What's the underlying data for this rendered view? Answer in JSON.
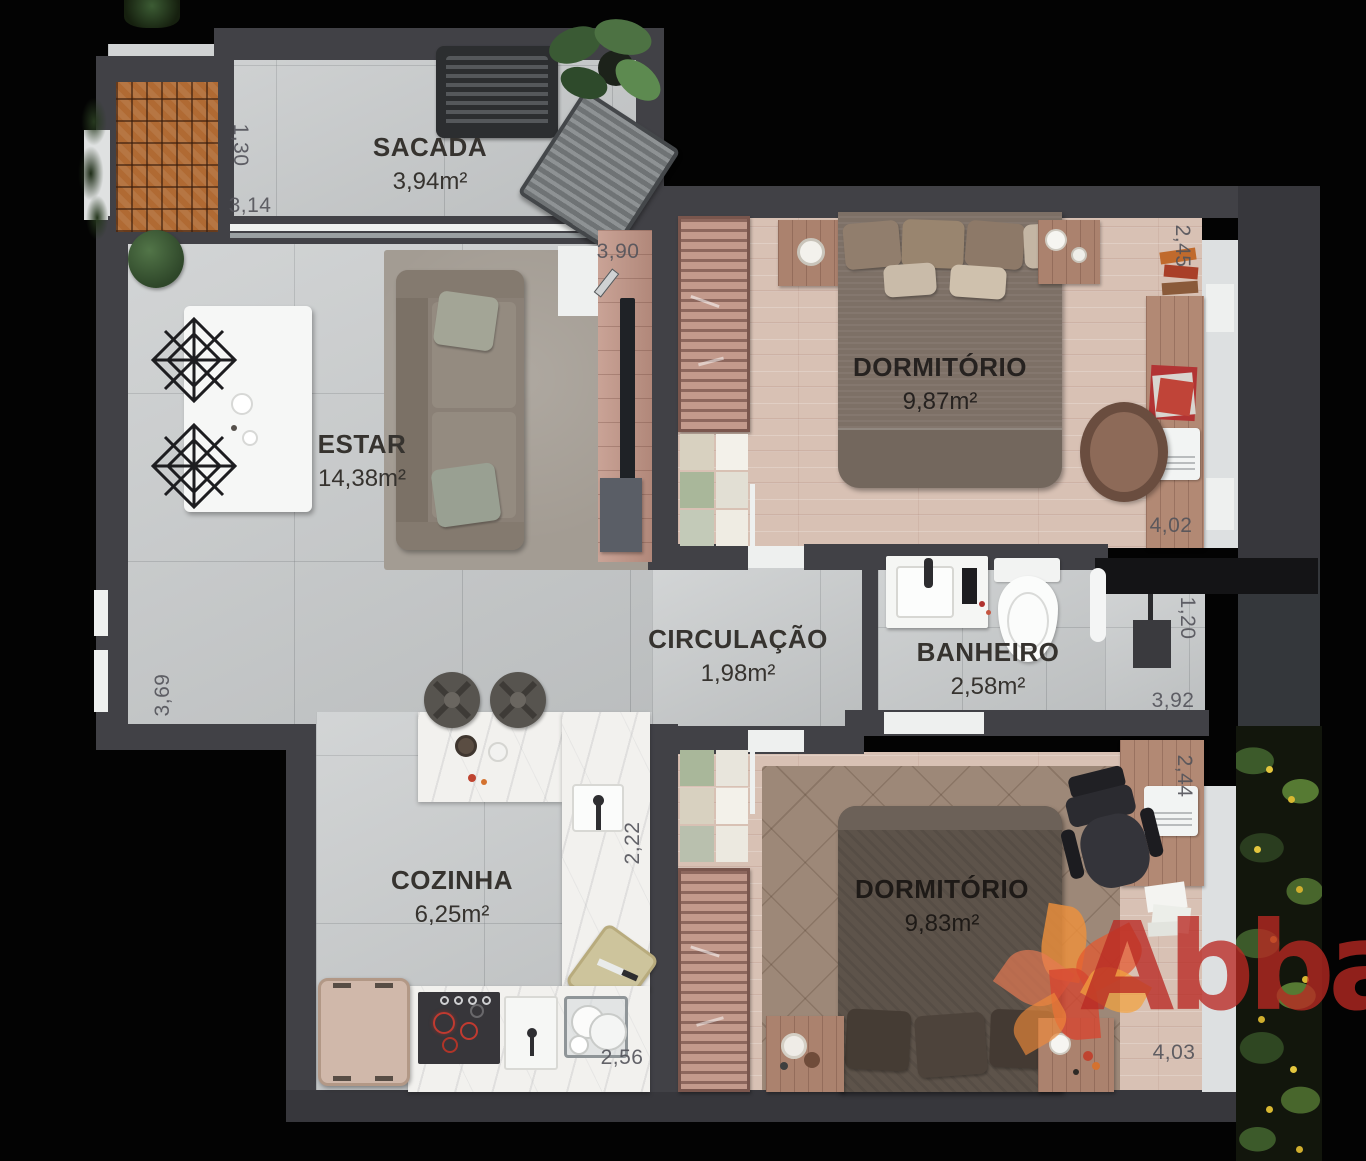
{
  "meta": {
    "type": "apartment-floor-plan-render",
    "language": "pt-BR"
  },
  "brand": {
    "watermark": "Abba"
  },
  "rooms": [
    {
      "id": "sacada",
      "name": "SACADA",
      "area": "3,94m²"
    },
    {
      "id": "estar",
      "name": "ESTAR",
      "area": "14,38m²"
    },
    {
      "id": "dormitorio-1",
      "name": "DORMITÓRIO",
      "area": "9,87m²"
    },
    {
      "id": "circulacao",
      "name": "CIRCULAÇÃO",
      "area": "1,98m²"
    },
    {
      "id": "banheiro",
      "name": "BANHEIRO",
      "area": "2,58m²"
    },
    {
      "id": "cozinha",
      "name": "COZINHA",
      "area": "6,25m²"
    },
    {
      "id": "dormitorio-2",
      "name": "DORMITÓRIO",
      "area": "9,83m²"
    }
  ],
  "dimensions": [
    {
      "value": "1,30",
      "orientation": "vertical",
      "location": "sacada-left"
    },
    {
      "value": "3,14",
      "orientation": "horizontal",
      "location": "sacada-bottom-left"
    },
    {
      "value": "3,90",
      "orientation": "horizontal",
      "location": "estar-tv-panel"
    },
    {
      "value": "2,45",
      "orientation": "vertical",
      "location": "dormitorio-1-right-top"
    },
    {
      "value": "4,02",
      "orientation": "horizontal",
      "location": "dormitorio-1-right-bottom"
    },
    {
      "value": "1,20",
      "orientation": "vertical",
      "location": "banheiro-right"
    },
    {
      "value": "3,92",
      "orientation": "horizontal",
      "location": "banheiro-right-bottom"
    },
    {
      "value": "3,69",
      "orientation": "vertical",
      "location": "estar-left"
    },
    {
      "value": "2,22",
      "orientation": "vertical",
      "location": "cozinha-counter-right"
    },
    {
      "value": "2,56",
      "orientation": "horizontal",
      "location": "cozinha-counter-bottom"
    },
    {
      "value": "2,44",
      "orientation": "vertical",
      "location": "dormitorio-2-right-top"
    },
    {
      "value": "4,03",
      "orientation": "horizontal",
      "location": "dormitorio-2-right-bottom"
    }
  ],
  "colors": {
    "wall": "#414146",
    "tile_floor": "#c6c9ca",
    "wood_floor": "#d8c1b4",
    "marble_counter": "#f2f1ee",
    "brick_grill": "#b06a33",
    "brand_red": "#b92923",
    "brand_orange": "#f0913b"
  }
}
